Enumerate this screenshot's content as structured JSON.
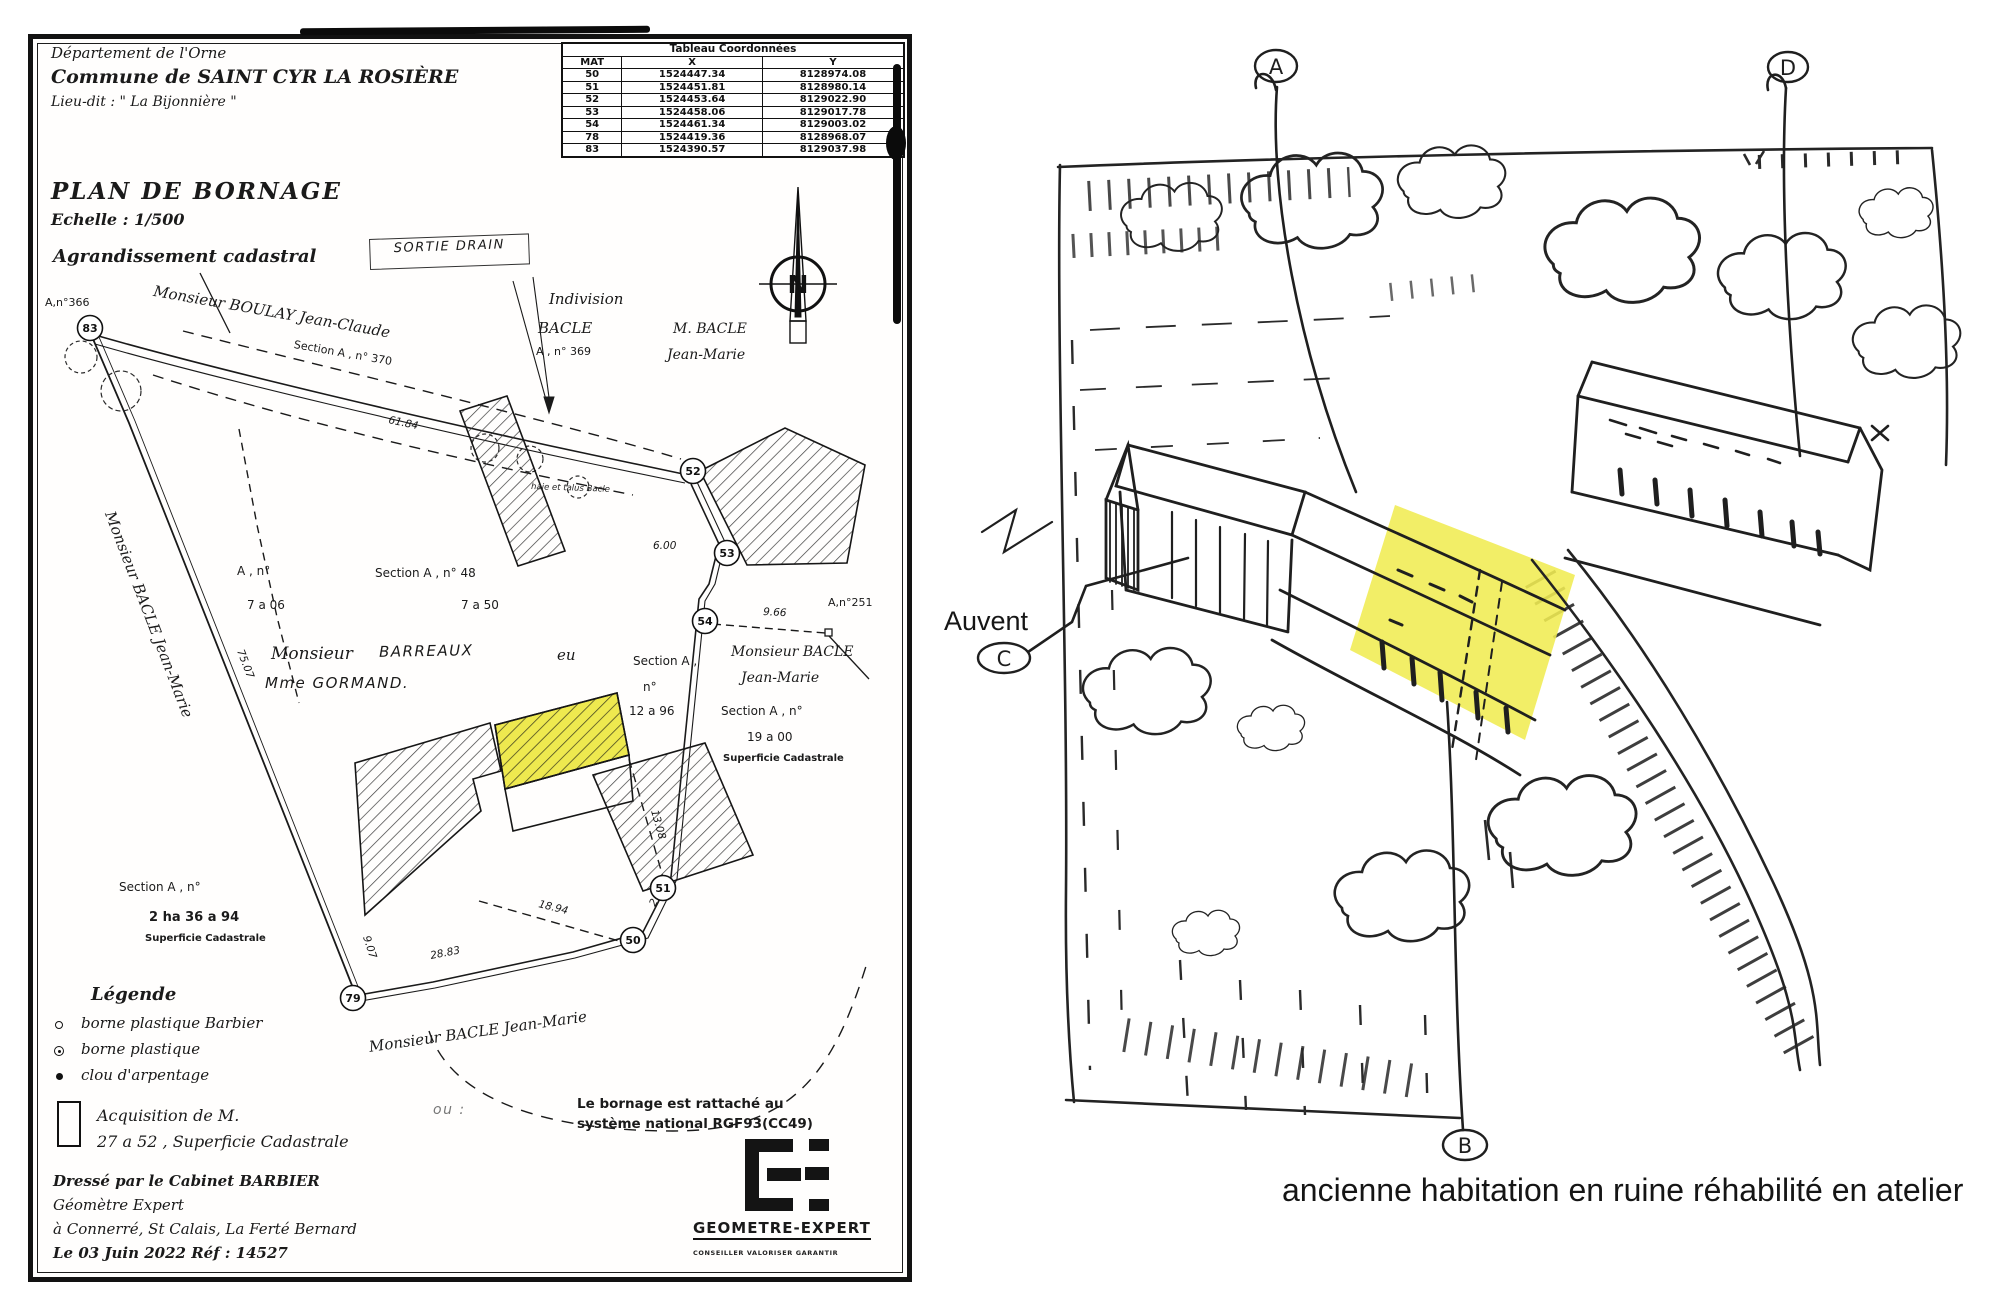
{
  "colors": {
    "ink": "#1a1a1a",
    "paper": "#ffffff",
    "highlight": "#eee94f",
    "sketch_ink": "#232323"
  },
  "plan": {
    "header": {
      "line1": "Département  de  l'Orne",
      "line2": "Commune de SAINT CYR LA ROSIÈRE",
      "line3": "Lieu-dit : \" La Bijonnière \""
    },
    "title": {
      "main": "PLAN   DE   BORNAGE",
      "scale": "Echelle : 1/500"
    },
    "coord_table": {
      "title": "Tableau Coordonnées",
      "columns": [
        "MAT",
        "X",
        "Y"
      ],
      "rows": [
        {
          "mat": "50",
          "x": "1524447.34",
          "y": "8128974.08"
        },
        {
          "mat": "51",
          "x": "1524451.81",
          "y": "8128980.14"
        },
        {
          "mat": "52",
          "x": "1524453.64",
          "y": "8129022.90"
        },
        {
          "mat": "53",
          "x": "1524458.06",
          "y": "8129017.78"
        },
        {
          "mat": "54",
          "x": "1524461.34",
          "y": "8129003.02"
        },
        {
          "mat": "78",
          "x": "1524419.36",
          "y": "8128968.07"
        },
        {
          "mat": "83",
          "x": "1524390.57",
          "y": "8129037.98"
        }
      ]
    },
    "labels": {
      "agrandissement": "Agrandissement cadastral",
      "sortie_drain": "SORTIE DRAIN",
      "parcel_366": "A,n°366",
      "owner_boulay": "Monsieur BOULAY Jean-Claude",
      "section_370": "Section A , n° 370",
      "indivision_1": "Indivision",
      "indivision_2": "BACLE",
      "indivision_3": "A , n° 369",
      "owner_mbacle_1": "M. BACLE",
      "owner_mbacle_2": "Jean-Marie",
      "haie": "haie et talus Bacle",
      "parcel_251": "A,n°251",
      "owner_bacle_right_1": "Monsieur BACLE",
      "owner_bacle_right_2": "Jean-Marie",
      "section_right_1": "Section A , n°",
      "section_right_2": "19 a 00",
      "section_right_3": "Superficie Cadastrale",
      "section_mid_1": "Section A ,",
      "section_mid_2": "n°",
      "section_mid_3": "12 a 96",
      "section_48": "Section A , n° 48",
      "area_48": "7 a 50",
      "parcel_left_1": "A , n°",
      "parcel_left_2": "7 a 06",
      "owner_mid_printed": "Monsieur",
      "owner_mid_hand": "BARREAUX",
      "owner_mid_et": "eu",
      "owner_mid_hand2": "Mme GORMAND.",
      "owner_bacle_left": "Monsieur BACLE Jean-Marie",
      "owner_bacle_bottom": "Monsieur BACLE Jean-Marie",
      "section_bl_1": "Section A , n°",
      "section_bl_2": "2 ha 36 a 94",
      "section_bl_3": "Superficie Cadastrale",
      "north": "N"
    },
    "dims": {
      "d1": "61.84",
      "d2": "75.07",
      "d3": "6.00",
      "d4": "9.66",
      "d5": "13.08",
      "d6": "18.94",
      "d7": "28.83",
      "d8": "9.07",
      "d9": "2.48"
    },
    "points": [
      {
        "id": "50"
      },
      {
        "id": "51"
      },
      {
        "id": "52"
      },
      {
        "id": "53"
      },
      {
        "id": "54"
      },
      {
        "id": "79"
      },
      {
        "id": "83"
      }
    ],
    "legend": {
      "title": "Légende",
      "items": [
        {
          "label": "borne plastique Barbier"
        },
        {
          "label": "borne plastique"
        },
        {
          "label": "clou d'arpentage"
        }
      ]
    },
    "acquisition": {
      "line1": "Acquisition de M.",
      "hand_note": "ou :",
      "line2": "27 a 52 , Superficie Cadastrale"
    },
    "georef": {
      "line1": "Le bornage est rattaché au",
      "line2": "système national RGF93(CC49)"
    },
    "footer": {
      "line1": "Dressé par le Cabinet BARBIER",
      "line2": "Géomètre Expert",
      "line3": "à Connerré, St Calais, La Ferté Bernard",
      "line4": "Le 03 Juin 2022     Réf : 14527"
    },
    "logo": {
      "name": "GEOMETRE-EXPERT",
      "tagline": "CONSEILLER VALORISER GARANTIR"
    }
  },
  "sketch": {
    "markers": {
      "a": "A",
      "b": "B",
      "c": "C",
      "d": "D"
    },
    "auvent": "Auvent",
    "caption": "ancienne habitation en ruine réhabilité en atelier"
  }
}
